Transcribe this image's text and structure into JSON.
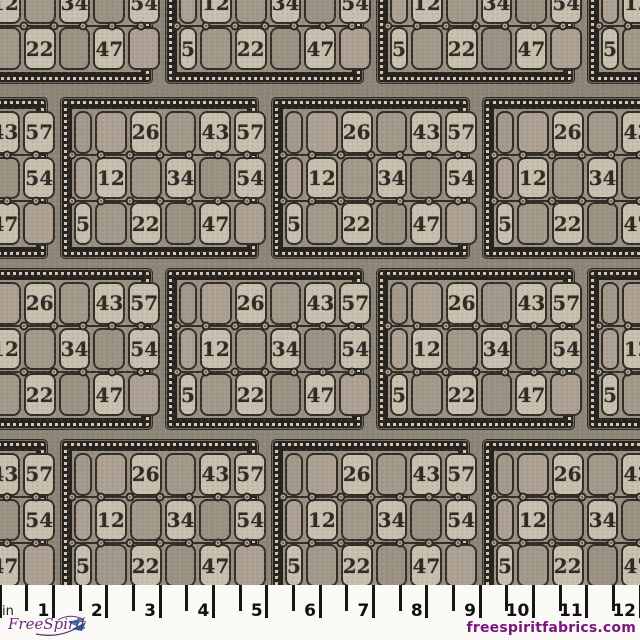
{
  "branding": {
    "logo_text": "FreeSpirit",
    "website": "freespiritfabrics.com"
  },
  "ruler": {
    "unit_label": "in",
    "inch_labels": [
      "1",
      "2",
      "3",
      "4",
      "5",
      "6",
      "7",
      "8",
      "9",
      "10",
      "11",
      "12"
    ]
  },
  "fabric": {
    "card_rows": [
      [
        "",
        "",
        "26",
        "",
        "43",
        "57"
      ],
      [
        "",
        "12",
        "",
        "34",
        "",
        "54"
      ],
      [
        "5",
        "",
        "22",
        "",
        "47",
        ""
      ]
    ],
    "bands": [
      {
        "top": -76,
        "cards_x": [
          -44,
          167,
          378,
          589
        ]
      },
      {
        "top": 99,
        "cards_x": [
          -149,
          62,
          273,
          484
        ]
      },
      {
        "top": 270,
        "cards_x": [
          -44,
          167,
          378,
          589
        ]
      },
      {
        "top": 441,
        "cards_x": [
          -149,
          62,
          273,
          484
        ]
      }
    ],
    "colors": {
      "background": "#8e8779",
      "card_frame_dark": "#27241f",
      "bead_dot": "#d2c9b6",
      "card_interior": "#9a9183",
      "cell_light": "#c9c1af",
      "cell_dark_shades": [
        "#a49a8b",
        "#ada293",
        "#9c9385"
      ],
      "ink": "#2f2b25",
      "eyelet_center": "#b3a998",
      "ruler_text": "#101010",
      "brand_purple": "#6d2a7f",
      "website_purple": "#7b1580",
      "brand_teal": "#2e8aa5"
    }
  }
}
